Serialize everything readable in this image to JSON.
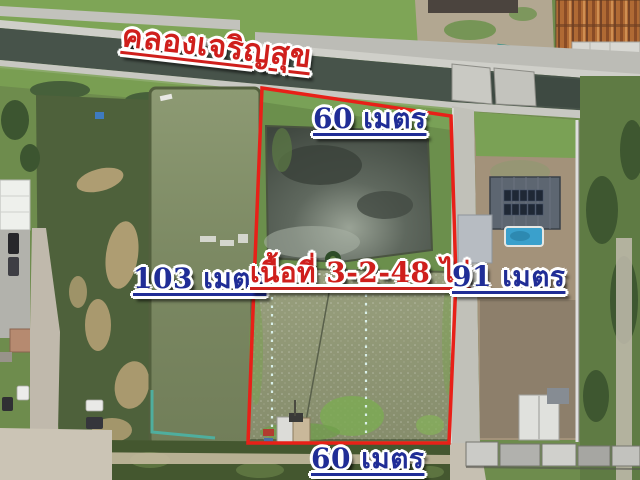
{
  "labels": {
    "canal_name": "คลองเจริญสุข",
    "top_width": "60 เมตร",
    "left_length": "103 เมตร",
    "area": "เนื้อที่ 3-2-48 ไร่",
    "right_length": "91 เมตร",
    "bottom_width": "60 เมตร"
  },
  "colors": {
    "boundary_red": "#e82018",
    "label_blue": "#202d96",
    "label_red": "#cf1f1c",
    "label_outline": "#ffffff"
  }
}
